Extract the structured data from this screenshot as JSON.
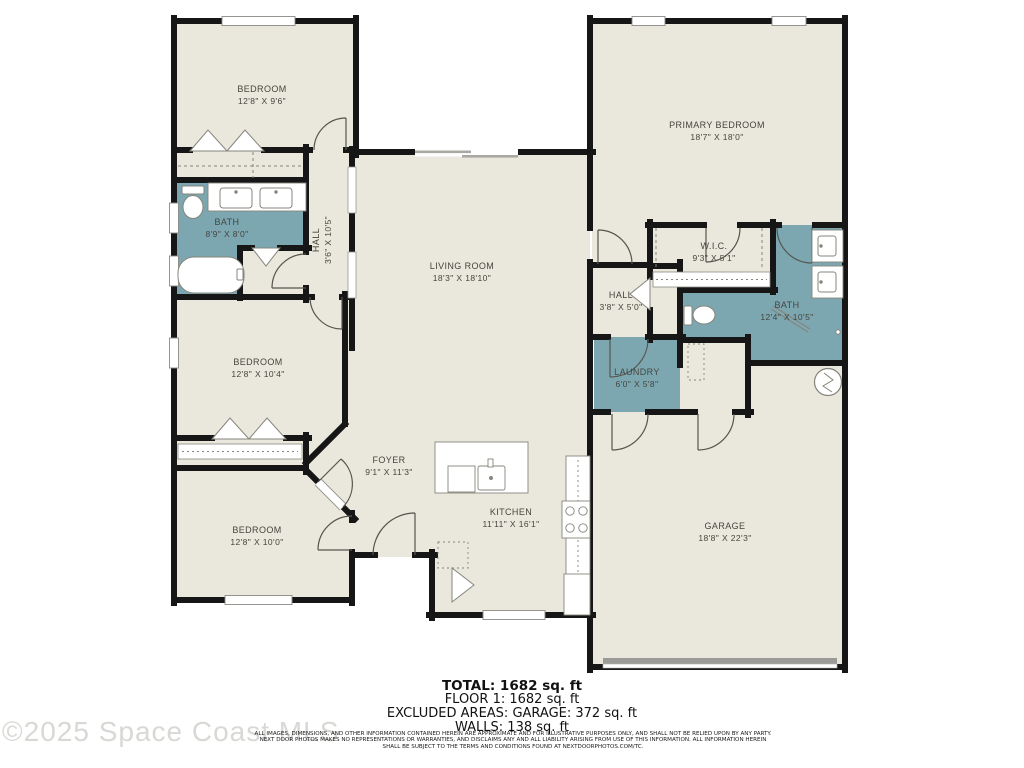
{
  "watermark": "©2025 Space Coast MLS",
  "colors": {
    "room_fill": "#eae8dc",
    "wet_room_fill": "#7ca7b1",
    "wall": "#161616",
    "fixture_stroke": "#85857c",
    "watermark_gray": "#d8d8d4"
  },
  "rooms": {
    "bedroom_top": {
      "name": "BEDROOM",
      "dims": "12'8\" X 9'6\""
    },
    "bath_left": {
      "name": "BATH",
      "dims": "8'9\" X 8'0\""
    },
    "hall_left": {
      "name": "HALL",
      "dims": "3'6\" X 10'5\""
    },
    "living": {
      "name": "LIVING ROOM",
      "dims": "18'3\" X 18'10\""
    },
    "primary": {
      "name": "PRIMARY BEDROOM",
      "dims": "18'7\" X 18'0\""
    },
    "wic": {
      "name": "W.I.C.",
      "dims": "9'3\" X 5'1\""
    },
    "hall_right": {
      "name": "HALL",
      "dims": "3'8\" X 5'0\""
    },
    "bath_primary": {
      "name": "BATH",
      "dims": "12'4\" X 10'5\""
    },
    "laundry": {
      "name": "LAUNDRY",
      "dims": "6'0\" X 5'8\""
    },
    "bedroom_mid": {
      "name": "BEDROOM",
      "dims": "12'8\" X 10'4\""
    },
    "foyer": {
      "name": "FOYER",
      "dims": "9'1\" X 11'3\""
    },
    "bedroom_bottom": {
      "name": "BEDROOM",
      "dims": "12'8\" X 10'0\""
    },
    "kitchen": {
      "name": "KITCHEN",
      "dims": "11'11\" X 16'1\""
    },
    "garage": {
      "name": "GARAGE",
      "dims": "18'8\" X 22'3\""
    }
  },
  "summary": {
    "total": "TOTAL: 1682 sq. ft",
    "floor": "FLOOR 1: 1682 sq. ft",
    "excluded": "EXCLUDED AREAS: GARAGE: 372 sq. ft",
    "walls": "WALLS: 138 sq. ft"
  },
  "disclaimer": {
    "line1": "ALL IMAGES, DIMENSIONS, AND OTHER INFORMATION CONTAINED HEREIN ARE APPROXIMATE AND FOR ILLUSTRATIVE PURPOSES ONLY, AND SHALL NOT BE RELIED UPON BY ANY PARTY.",
    "line2": "NEXT DOOR PHOTOS MAKES NO REPRESENTATIONS OR WARRANTIES, AND DISCLAIMS ANY AND ALL LIABILITY ARISING FROM USE OF THIS INFORMATION. ALL INFORMATION HEREIN",
    "line3": "SHALL BE SUBJECT TO THE TERMS AND CONDITIONS FOUND AT NEXTDOORPHOTOS.COM/TC."
  }
}
